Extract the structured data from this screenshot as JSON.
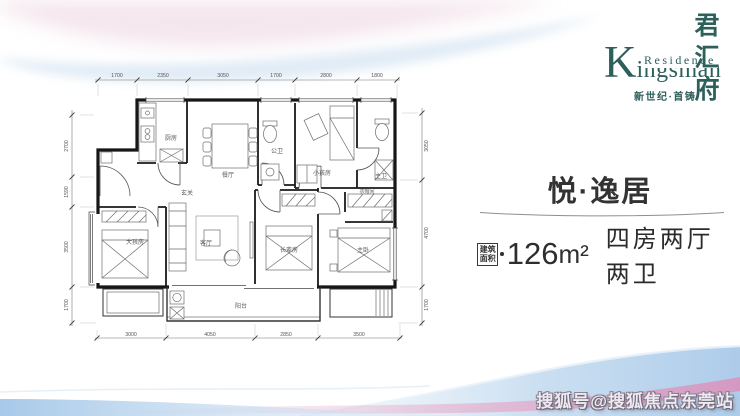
{
  "brand": {
    "initial": "K",
    "name_rest": "ingsman",
    "residence": "Residence",
    "name_cn": "君汇府",
    "tagline": "新世纪·首铸",
    "color": "#2d5f5b"
  },
  "panel": {
    "title": "悦·逸居",
    "area_box_line1": "建筑",
    "area_box_line2": "面积",
    "area_value": "126",
    "area_unit": "m²",
    "layout_text": "四房两厅两卫"
  },
  "watermark": {
    "text": "搜狐号@搜狐焦点东莞站"
  },
  "floorplan": {
    "rooms": {
      "kitchen": "厨房",
      "dining": "餐厅",
      "guest_bath": "公卫",
      "kids_room": "小孩房",
      "master_bath": "主卫",
      "closet": "衣帽间",
      "entry": "玄关",
      "big_kid_room": "大孩房",
      "living": "客厅",
      "elder_room": "长辈房",
      "master_room": "主卧",
      "balcony": "阳台"
    },
    "dims": {
      "top": [
        "1700",
        "2350",
        "3050",
        "1700",
        "2800",
        "1800"
      ],
      "left": [
        "2700",
        "1590",
        "3500",
        "1700"
      ],
      "right": [
        "3050",
        "4700",
        "1700"
      ],
      "bottom": [
        "3000",
        "4050",
        "2850",
        "3500"
      ]
    }
  },
  "colors": {
    "wave_blue": "#aecde9",
    "wave_pink": "#dca4c6",
    "text_dark": "#333333"
  }
}
